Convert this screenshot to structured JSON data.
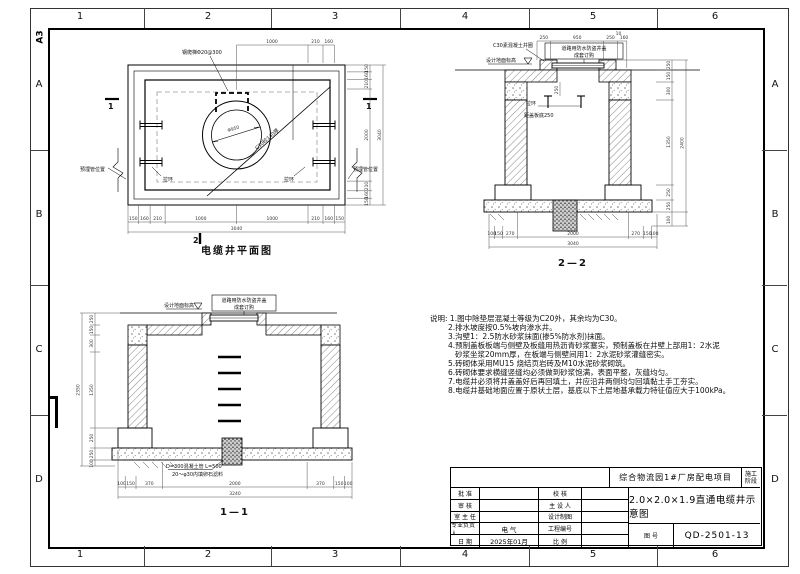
{
  "sheet": {
    "size_label": "A3",
    "cols": [
      "1",
      "2",
      "3",
      "4",
      "5",
      "6"
    ],
    "rows": [
      "A",
      "B",
      "C",
      "D"
    ]
  },
  "plan": {
    "title": "电缆井平面图",
    "section_marker_bottom": "2",
    "section_marker_side_left": "1",
    "section_marker_side_right": "1",
    "ladder_label": "钢爬梯Φ20@300",
    "circle_label": "Φ950",
    "diagonal_label": "C30砼140厚",
    "pull_ring_left": "拉环",
    "pull_ring_right": "拉环",
    "embedded_pipe_left": "预埋管位置",
    "embedded_pipe_right": "预埋管位置",
    "dim_top": [
      "1000",
      "210",
      "160"
    ],
    "dim_bottom": [
      "150",
      "160",
      "210",
      "1000",
      "1000",
      "210",
      "160",
      "150"
    ],
    "dim_bottom_total": "3040",
    "dim_right": [
      "150",
      "160",
      "210",
      "2000",
      "210",
      "160",
      "150"
    ],
    "dim_right_total": "3040"
  },
  "sec22": {
    "title": "2—2",
    "collar_label": "C30素混凝土井圈",
    "ground_label": "设计地面标高",
    "cover_label_line1": "道路用防水防盗井盖",
    "cover_label_line2": "成套订购",
    "pull_ring_label": "拉环",
    "slab_offset_label": "距盖板底250",
    "inner_dim": "250",
    "dim_top": [
      "250",
      "950",
      "250",
      "10",
      "160"
    ],
    "dim_right": [
      "250",
      "150",
      "300",
      "1350",
      "250",
      "250",
      "100"
    ],
    "dim_right_total": "2400",
    "dim_bottom": [
      "100",
      "150",
      "270",
      "2000",
      "270",
      "150",
      "100"
    ],
    "dim_bottom_total": "3040"
  },
  "sec11": {
    "title": "1—1",
    "ground_label": "设计地面标高",
    "cover_label_line1": "道路用防水防盗井盖",
    "cover_label_line2": "成套订购",
    "pipe_label_line1": "D=300混凝土管 L=500",
    "pipe_label_line2": "20～φ30内填卵石滤料",
    "dim_left": [
      "250",
      "150",
      "300",
      "1350",
      "250",
      "250",
      "100"
    ],
    "dim_left_total": "2350",
    "dim_bottom": [
      "100",
      "150",
      "370",
      "2000",
      "370",
      "150",
      "100"
    ],
    "dim_bottom_total": "3240"
  },
  "notes": {
    "heading": "说明:",
    "lines": [
      "1.图中除垫层混凝土等级为C20外，其余均为C30。",
      "2.排水坡度按0.5%坡向渗水井。",
      "3.沟壁1：2.5防水砂浆抹面(掺5%防水剂)抹面。",
      "4.预制盖板板端与侧壁及板缝用热沥青砂浆塞实，预制盖板在井壁上部用1：2水泥",
      "砂浆坐浆20mm厚，在板端与侧壁间用1：2水泥砂浆灌缝密实。",
      "5.砖砌体采用MU15 烧结页岩砖及M10水泥砂浆砌筑。",
      "6.砖砌体要求横缝竖缝均必须做到砂浆饱满，表面平整，灰缝均匀。",
      "7.电缆井必须将井盖盖好后再回填土，井应沿井两侧均匀回填黏土手工夯实。",
      "8.电缆井基础地面应置于原状土层，基底以下土层地基承载力特征值应大于100kPa。"
    ]
  },
  "titleblock": {
    "project": "综合物流园1#厂房配电项目",
    "stage_line1": "施工",
    "stage_line2": "阶段",
    "drawing_title": "2.0×2.0×1.9直通电缆井示意图",
    "no_label": "图  号",
    "no_value": "QD-2501-13",
    "left_labels": [
      "批 准",
      "审 核",
      "室 主 任",
      "专业负责人",
      "日 期"
    ],
    "left_values": [
      "",
      "",
      "",
      "电 气",
      "2025年01月"
    ],
    "mid_labels": [
      "校 核",
      "主 设 人",
      "设计制图",
      "工程编号",
      "比 例"
    ],
    "mid_values": [
      "",
      "",
      "",
      "",
      ""
    ]
  }
}
